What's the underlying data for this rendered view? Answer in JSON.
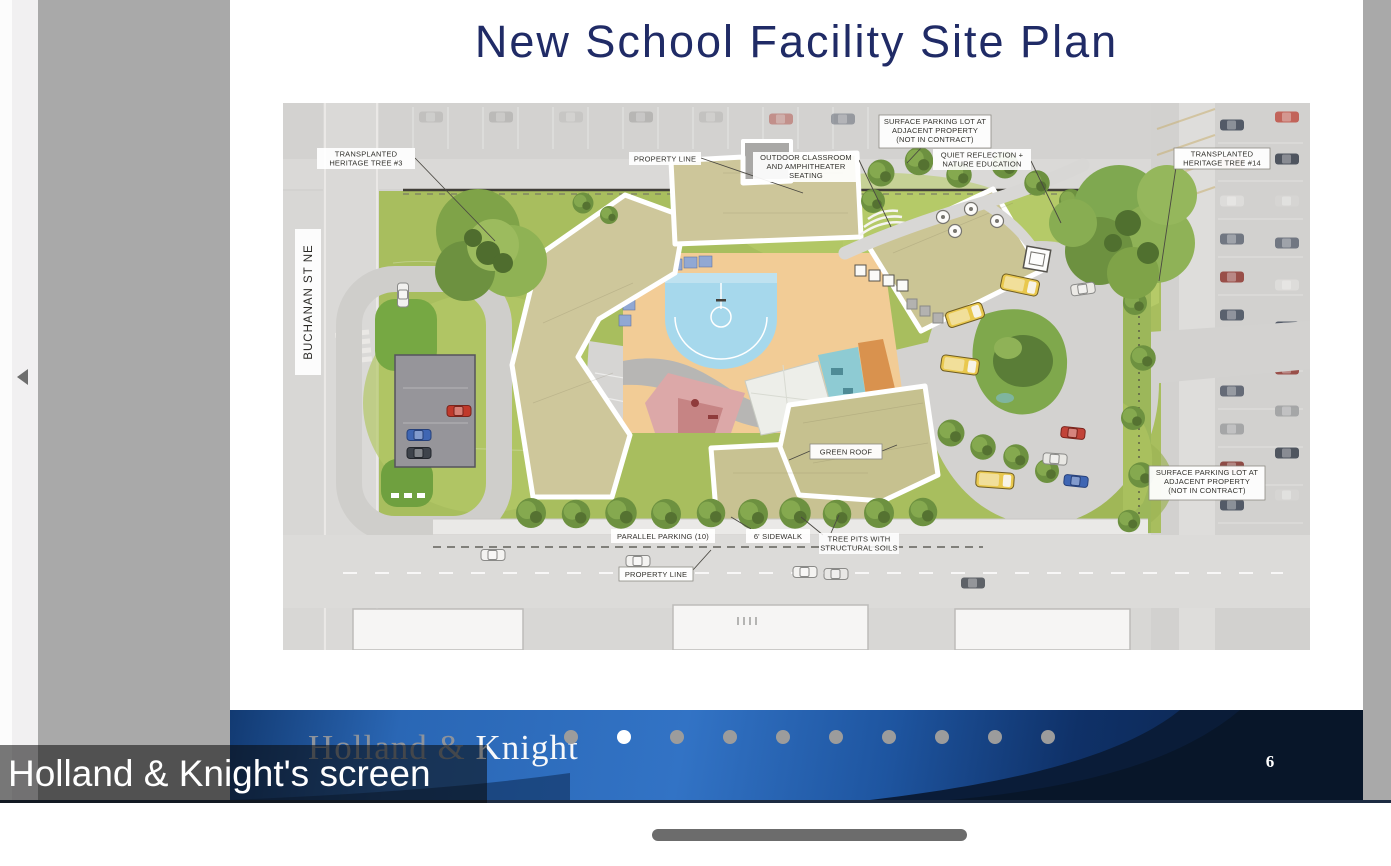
{
  "screen_share": {
    "overlay_label": "Holland & Knight's screen"
  },
  "slide": {
    "title": "New School Facility Site Plan",
    "page_number": "6",
    "logo": {
      "part1": "Holland",
      "amp": " & ",
      "part2": "Knight"
    },
    "pagination": {
      "total": 10,
      "active_position": 2
    }
  },
  "site_plan": {
    "street_label": "BUCHANAN ST NE",
    "labels": [
      {
        "id": "transplanted-tree-3",
        "lines": [
          "TRANSPLANTED",
          "HERITAGE TREE #3"
        ]
      },
      {
        "id": "property-line-top",
        "lines": [
          "PROPERTY LINE"
        ]
      },
      {
        "id": "outdoor-classroom",
        "lines": [
          "OUTDOOR CLASSROOM",
          "AND AMPHITHEATER",
          "SEATING"
        ]
      },
      {
        "id": "surface-parking-top",
        "lines": [
          "SURFACE PARKING LOT AT",
          "ADJACENT PROPERTY",
          "(NOT IN CONTRACT)"
        ]
      },
      {
        "id": "quiet-reflection",
        "lines": [
          "QUIET REFLECTION +",
          "NATURE EDUCATION"
        ]
      },
      {
        "id": "transplanted-tree-14",
        "lines": [
          "TRANSPLANTED",
          "HERITAGE TREE #14"
        ]
      },
      {
        "id": "green-roof",
        "lines": [
          "GREEN ROOF"
        ]
      },
      {
        "id": "parallel-parking",
        "lines": [
          "PARALLEL PARKING (10)"
        ]
      },
      {
        "id": "sidewalk",
        "lines": [
          "6' SIDEWALK"
        ]
      },
      {
        "id": "tree-pits",
        "lines": [
          "TREE PITS WITH",
          "STRUCTURAL SOILS"
        ]
      },
      {
        "id": "property-line-bottom",
        "lines": [
          "PROPERTY LINE"
        ]
      },
      {
        "id": "surface-parking-right",
        "lines": [
          "SURFACE PARKING LOT AT",
          "ADJACENT PROPERTY",
          "(NOT IN CONTRACT)"
        ]
      }
    ]
  },
  "icons": {
    "collapse_arrow": "left-triangle"
  },
  "colors": {
    "title": "#202b66",
    "footer_blue": "#3273c5",
    "footer_navy": "#0a1c38",
    "lawn": "#a8be5e",
    "dot_active": "#ffffff",
    "dot_inactive": "#9c9c9c",
    "overlay_bg": "rgba(10,10,10,0.55)",
    "surround_gray": "#a9a9a9"
  }
}
